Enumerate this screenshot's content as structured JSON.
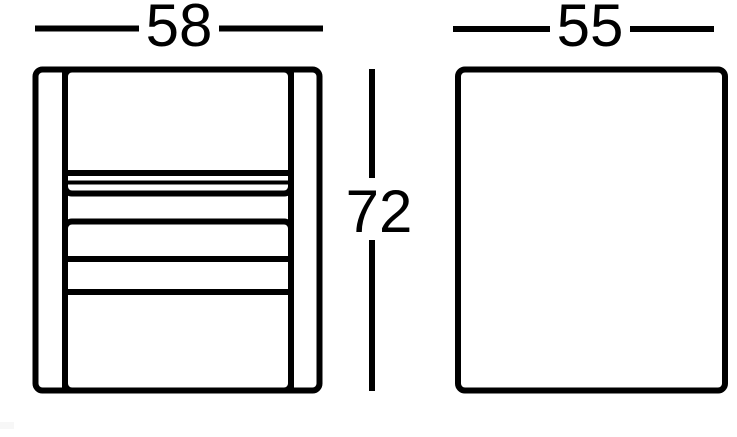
{
  "diagram": {
    "type": "furniture-dimension-drawing",
    "ink_color": "#000000",
    "background_color": "#ffffff",
    "views": {
      "front": {
        "name": "front-view"
      },
      "side": {
        "name": "side-view"
      }
    },
    "dimensions": {
      "front_width": {
        "label": "58"
      },
      "side_depth": {
        "label": "55"
      },
      "height": {
        "label": "72"
      }
    }
  }
}
